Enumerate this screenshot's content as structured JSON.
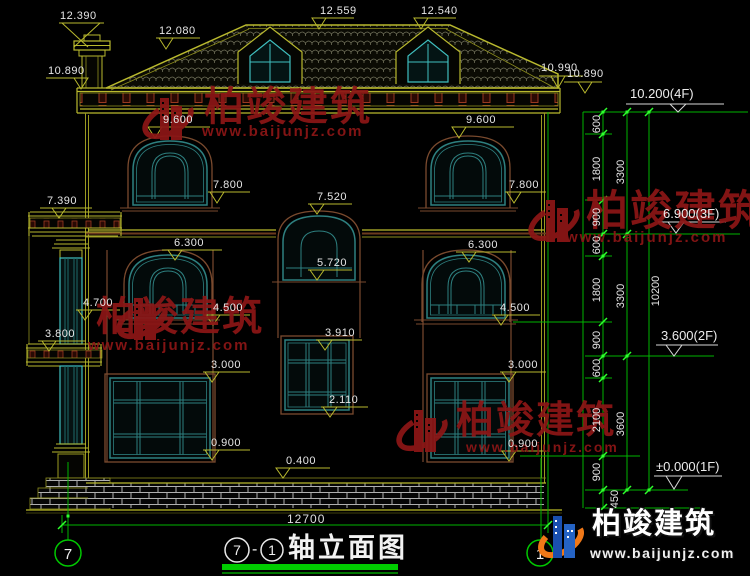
{
  "drawing": {
    "kind": "architectural elevation (CAD)",
    "bottom_dim": "12700",
    "title_block": {
      "axis_from": "7",
      "dash": "-",
      "axis_to": "1",
      "name": "轴立面图"
    },
    "axis_bubbles": {
      "left": "7",
      "right": "1"
    },
    "levels": {
      "f4": "10.200(4F)",
      "f3": "6.900(3F)",
      "f2": "3.600(2F)",
      "f1": "±0.000(1F)"
    },
    "elevation_marks": {
      "m12390": "12.390",
      "m12080": "12.080",
      "m12559": "12.559",
      "m12540": "12.540",
      "m10890L": "10.890",
      "m10990": "10.990",
      "m10890R": "10.890",
      "m9600L": "9.600",
      "m9600R": "9.600",
      "m7800L": "7.800",
      "m7800R": "7.800",
      "m7520": "7.520",
      "m5720": "5.720",
      "m7390": "7.390",
      "m6300L": "6.300",
      "m6300R": "6.300",
      "m4700": "4.700",
      "m4500L": "4.500",
      "m4500R": "4.500",
      "m3800": "3.800",
      "m3910": "3.910",
      "m3000L": "3.000",
      "m3000R": "3.000",
      "m2110": "2.110",
      "m0900L": "0.900",
      "m0900R": "0.900",
      "m0400": "0.400"
    },
    "vertical_dims": {
      "a600": "600",
      "a1800": "1800",
      "a900": "900",
      "a3300": "3300",
      "b600": "600",
      "b1800": "1800",
      "b900": "900",
      "b3300": "3300",
      "c600": "600",
      "c2100": "2100",
      "c900": "900",
      "c3600": "3600",
      "d450": "450",
      "total": "10200"
    },
    "watermark": {
      "brand": "柏竣建筑",
      "site": "www.baijunjz.com"
    },
    "logo": {
      "brand": "柏竣建筑",
      "site": "www.baijunjz.com"
    },
    "colors": {
      "background": "#000000",
      "dim_green": "#00b400",
      "tick_green": "#2eff2e",
      "line_olive": "#9a9a20",
      "line_bright": "#b9b92e",
      "frame_teal": "#2e8080",
      "column_cyan": "#3fbfbf",
      "surround_brown": "#7a4a2e",
      "dentil_red": "#9a3820",
      "watermark_red": "#8c1616",
      "logo_blue": "#2563c4",
      "logo_orange": "#f07818",
      "title_underline": "#00cc00"
    }
  }
}
